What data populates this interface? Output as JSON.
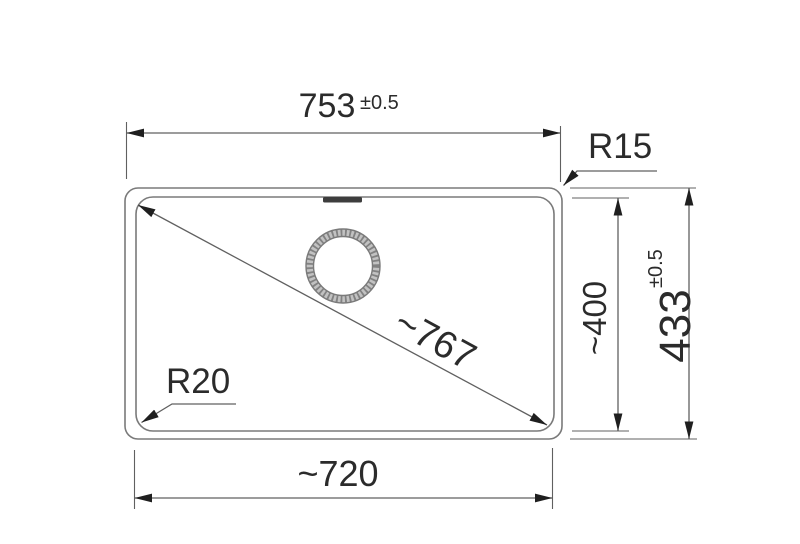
{
  "dimensions": {
    "width_top": {
      "value": "753",
      "tolerance": "±0.5"
    },
    "width_bottom": {
      "value": "~720"
    },
    "height_inner": {
      "value": "~400"
    },
    "height_outer": {
      "value": "433",
      "tolerance": "±0.5"
    },
    "diagonal": {
      "value": "~767"
    },
    "corner_radius_outer": {
      "label": "R15"
    },
    "corner_radius_inner": {
      "label": "R20"
    }
  },
  "colors": {
    "line": "#7a7a7a",
    "dim_line": "#606060",
    "arrow": "#1f1f1f",
    "text": "#2b2b2b",
    "background": "#ffffff",
    "drain_ring_base": "#c2c2c2",
    "drain_ring_hatch": "#828282",
    "overflow_slot": "#3d3d3d"
  }
}
